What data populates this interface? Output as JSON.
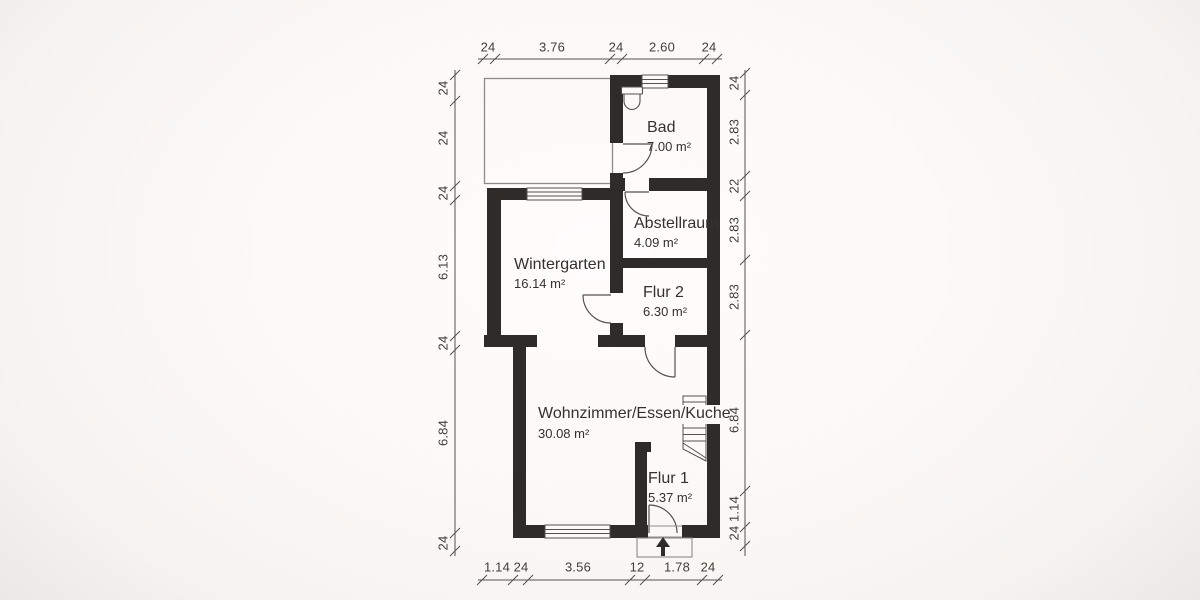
{
  "document": {
    "type": "residential floor plan"
  },
  "rooms": [
    {
      "name": "Bad",
      "area": "7.00 m²"
    },
    {
      "name": "Abstellraum",
      "area": "4.09 m²"
    },
    {
      "name": "Wintergarten",
      "area": "16.14 m²"
    },
    {
      "name": "Flur 2",
      "area": "6.30 m²"
    },
    {
      "name": "Wohnzimmer/Essen/Kuche",
      "area": "30.08 m²"
    },
    {
      "name": "Flur 1",
      "area": "5.37 m²"
    }
  ],
  "dimensions": {
    "top": [
      "24",
      "3.76",
      "24",
      "2.60",
      "24"
    ],
    "bottom": [
      "1.14",
      "24",
      "3.56",
      "12",
      "1.78",
      "24"
    ],
    "left": [
      "24",
      "24",
      "24",
      "6.13",
      "24",
      "6.84",
      "24"
    ],
    "right": [
      "24",
      "2.83",
      "22",
      "2.83",
      "2.83",
      "6.84",
      "1.14",
      "24"
    ]
  },
  "symbols": [
    "toilet-icon",
    "stairs-icon",
    "entrance-arrow-icon",
    "door-swing",
    "window"
  ],
  "colors": {
    "wall": "#2f2b28",
    "paper": "#fbfaf8",
    "line": "#55504c",
    "thin": "#8d8a87",
    "text": "#353130",
    "dim_text": "#423e3a"
  }
}
